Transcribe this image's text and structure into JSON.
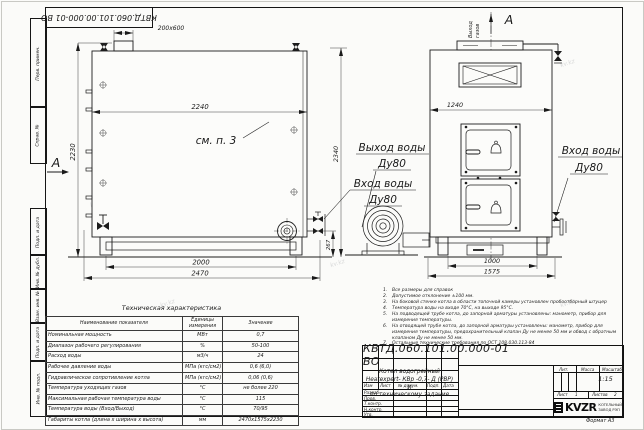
{
  "watermark": "kv.kz",
  "sheet": {
    "stamp_top": "КВТД.060.101.00.000-01 ВО",
    "format_label": "Формат А3",
    "margin_labels": [
      "Перв. примен.",
      "Справ. №",
      "Подп. и дата",
      "Инв. № дубл.",
      "Взам. инв. №",
      "Подп. и дата",
      "Инв. № подл."
    ]
  },
  "drawing": {
    "section_letter": "А",
    "see_note": "см. п. 3",
    "labels": {
      "water_out_title": "Выход воды",
      "water_out_dn": "Ду80",
      "water_in_title": "Вход воды",
      "water_in_dn": "Ду80",
      "water_in_right_title": "Вход воды",
      "water_in_right_dn": "Ду80",
      "gas_out_word1": "Выход",
      "gas_out_word2": "газов"
    },
    "dims": {
      "duct": "200x600",
      "side_width": "2240",
      "side_height": "2230",
      "base_span": "2000",
      "overall_length": "2470",
      "stub_height": "267",
      "overall_height": "2340",
      "front_width": "1240",
      "front_base": "1000",
      "front_overall": "1575"
    }
  },
  "tech_table": {
    "title": "Техническая характеристика",
    "headers": [
      "Наименование показателя",
      "Единицы измерения",
      "Значение"
    ],
    "rows": [
      {
        "name": "Номинальная мощность",
        "unit": "МВт",
        "value": "0,7"
      },
      {
        "name": "Диапазон рабочего регулирования",
        "unit": "%",
        "value": "50-100"
      },
      {
        "name": "Расход воды",
        "unit": "м3/ч",
        "value": "24"
      },
      {
        "name": "Рабочее давление воды",
        "unit": "МПа (кгс/см2)",
        "value": "0,6 (6,0)"
      },
      {
        "name": "Гидравлическое сопротивление котла",
        "unit": "МПа (кгс/см2)",
        "value": "0,06 (0,6)"
      },
      {
        "name": "Температура уходящих газов",
        "unit": "°С",
        "value": "не более 220"
      },
      {
        "name": "Максимальная рабочая температура воды",
        "unit": "°С",
        "value": "115"
      },
      {
        "name": "Температура воды (Вход/Выход)",
        "unit": "°С",
        "value": "70/95"
      },
      {
        "name": "Габариты котла (длина х ширина х высота)",
        "unit": "мм",
        "value": "2470х1575х2230"
      }
    ]
  },
  "notes": [
    {
      "num": "1.",
      "text": "Все размеры для справок"
    },
    {
      "num": "2.",
      "text": "Допустимое отклонение ±100 мм."
    },
    {
      "num": "3.",
      "text": "На боковой стенке котла в области топочной камеры установлен пробоотборный штуцер"
    },
    {
      "num": "4.",
      "text": "Температура воды на входе 70°С, на выходе 95°С."
    },
    {
      "num": "5.",
      "text": "На подводящей трубе котла, до запорной арматуры установлены: манометр, прибор для измерения температуры."
    },
    {
      "num": "6.",
      "text": "На отводящей трубе котла, до запорной арматуры установлены: манометр, прибор для измерения температуры, предохранительный клапан Ду не менее 50 мм и обвод с обратным клапаном Ду не менее 50 мм."
    },
    {
      "num": "7.",
      "text": "Остальные технические требования по ОСТ 108.030.113-84"
    }
  ],
  "title_block": {
    "doc_number": "КВТД.060.101.00.000-01  ВО",
    "product_line1": "Котел водогрейный",
    "product_line2": "Heatexpert- КВр -0,7- Д (РВР) И",
    "product_line3": "по техническому задание",
    "change_header": [
      "Изм",
      "Лист",
      "№ докум.",
      "Подп.",
      "Дата"
    ],
    "roles": [
      "Разраб.",
      "Пров.",
      "Т.контр.",
      "Н.контр.",
      "Утв."
    ],
    "lit_label": "Лит.",
    "mass_label": "Масса",
    "scale_label": "Масштаб",
    "scale_value": "1:15",
    "sheet_label": "Лист",
    "sheet_value": "1",
    "sheets_label": "Листов",
    "sheets_value": "2",
    "logo_text": "KVZR",
    "company_line1": "КОТЕЛЬНЫЙ",
    "company_line2": "ЗАВОД РЭП"
  }
}
